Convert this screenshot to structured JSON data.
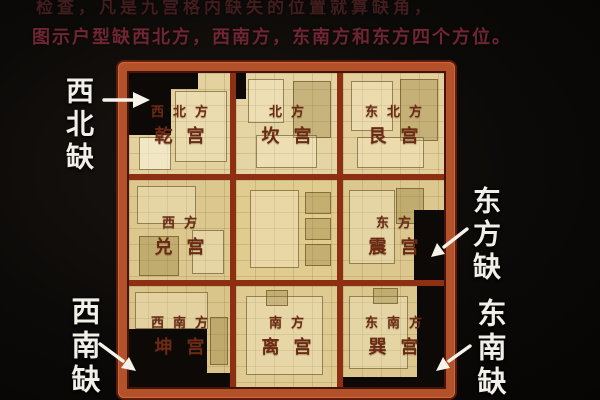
{
  "header": {
    "line1": "检查，凡是九宫格内缺失的位置就算缺角，",
    "line2": "图示户型缺西北方，西南方，东南方和东方四个方位。"
  },
  "grid": {
    "cells": [
      {
        "direction": "西北方",
        "palace": "乾宫"
      },
      {
        "direction": "北方",
        "palace": "坎宫"
      },
      {
        "direction": "东北方",
        "palace": "艮宫"
      },
      {
        "direction": "西方",
        "palace": "兑宫"
      },
      {
        "direction": "",
        "palace": ""
      },
      {
        "direction": "东方",
        "palace": "震宫"
      },
      {
        "direction": "西南方",
        "palace": "坤宫"
      },
      {
        "direction": "南方",
        "palace": "离宫"
      },
      {
        "direction": "东南方",
        "palace": "巽宫"
      }
    ]
  },
  "callouts": {
    "northwest": "西北缺",
    "east": "东方缺",
    "southwest": "西南缺",
    "southeast": "东南缺"
  },
  "colors": {
    "frame": "#b3512b",
    "grid_line": "#8c2f12",
    "floor": "#dcc88f",
    "missing_area": "#0c0907",
    "palace_text": "#6b2a14",
    "callout_text": "#f2efe9",
    "header_line1": "#421d1d",
    "header_line2": "#702632"
  }
}
